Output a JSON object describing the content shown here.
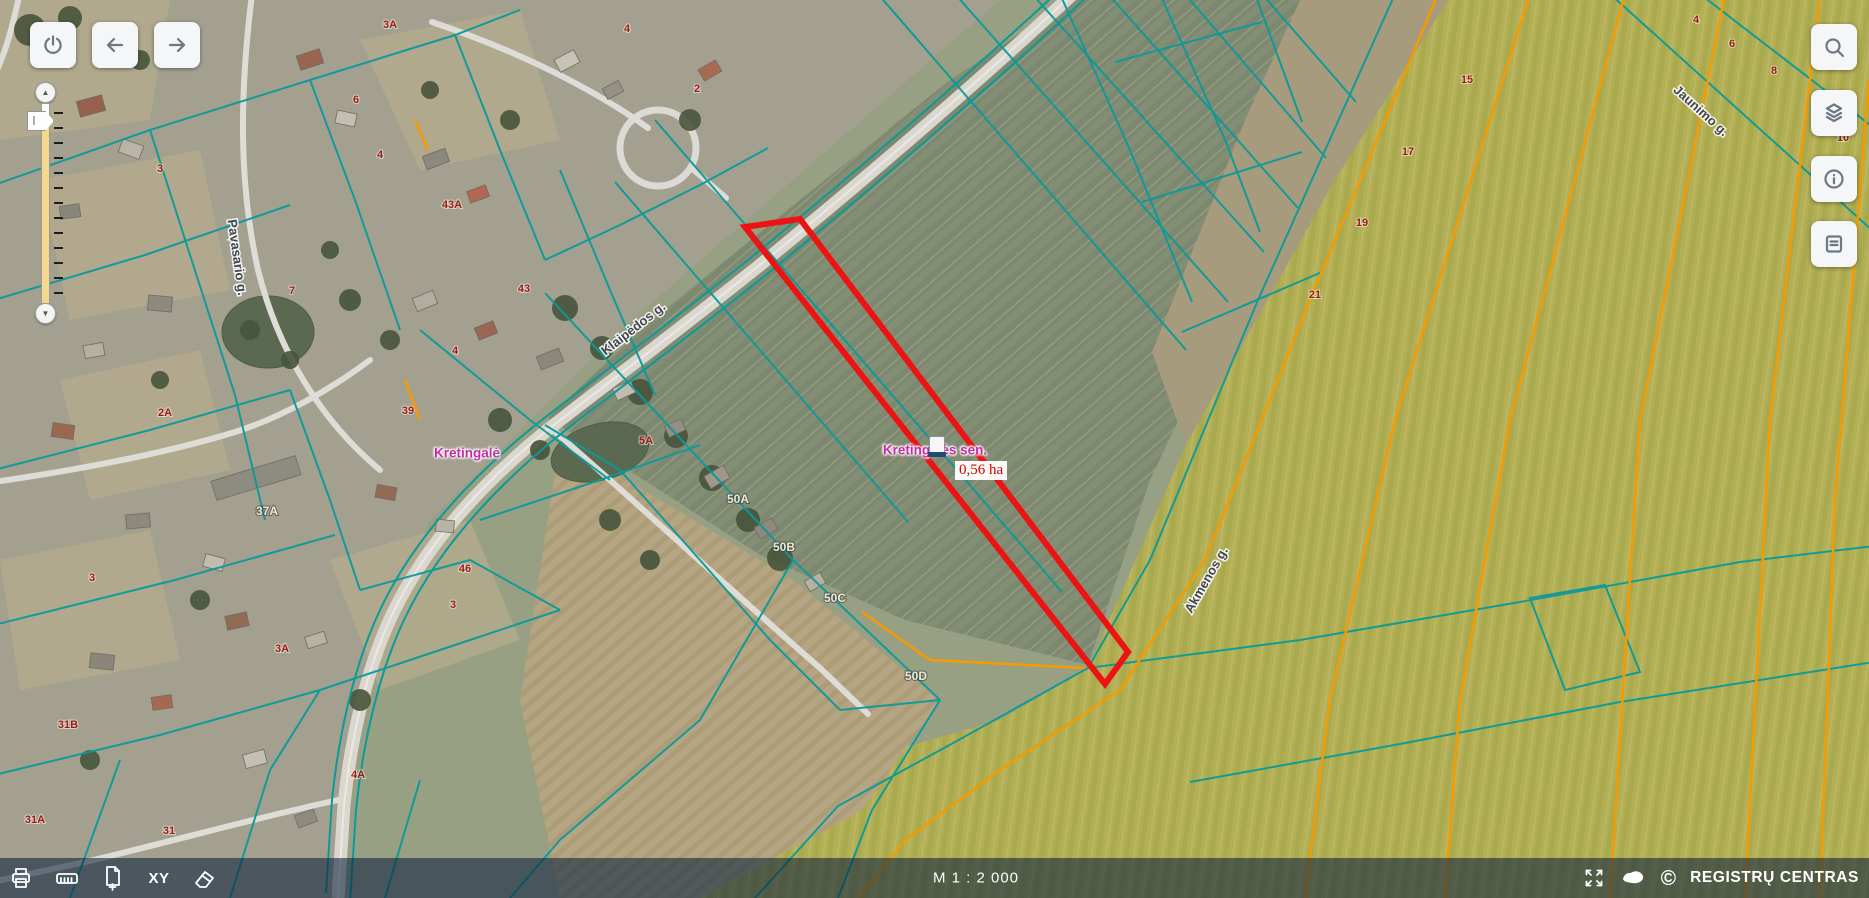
{
  "toolbars": {
    "top_left": [
      {
        "id": "power"
      },
      {
        "id": "back"
      },
      {
        "id": "forward"
      }
    ],
    "top_right": [
      {
        "id": "search"
      },
      {
        "id": "layers"
      },
      {
        "id": "info"
      },
      {
        "id": "legend"
      }
    ]
  },
  "bottombar": {
    "tools_left": [
      "print",
      "measure-ruler",
      "add-page",
      "xy-coordinates",
      "eraser"
    ],
    "xy_label": "XY",
    "scale": "M 1 : 2 000",
    "tools_right": [
      "fullscreen",
      "lithuania-map"
    ],
    "copyright_symbol": "©",
    "brand": "REGISTRŲ CENTRAS"
  },
  "map": {
    "selection": {
      "name": "Kretingalės sen.",
      "area": "0,56 ha"
    },
    "place": "Kretingalė",
    "colors": {
      "cadastral_line": "#0a9a9a",
      "agro_block_line": "#f59b00",
      "selected_parcel": "#ed1313",
      "label_magenta": "#c42ca5",
      "area_label_red": "#d40000",
      "road": "#d9d7cf"
    },
    "street_labels": [
      {
        "t": "Klaipėdos g.",
        "x": 636,
        "y": 332,
        "r": -38
      },
      {
        "t": "Pavasario g.",
        "x": 233,
        "y": 258,
        "r": 82
      },
      {
        "t": "Akmenos g.",
        "x": 1210,
        "y": 582,
        "r": -60
      },
      {
        "t": "Jaunimo g.",
        "x": 1698,
        "y": 114,
        "r": 42
      }
    ],
    "house_numbers_red": [
      {
        "t": "3A",
        "x": 390,
        "y": 28
      },
      {
        "t": "4",
        "x": 627,
        "y": 32
      },
      {
        "t": "6",
        "x": 356,
        "y": 103
      },
      {
        "t": "2",
        "x": 697,
        "y": 92
      },
      {
        "t": "3",
        "x": 160,
        "y": 172
      },
      {
        "t": "4",
        "x": 380,
        "y": 158
      },
      {
        "t": "43A",
        "x": 452,
        "y": 208
      },
      {
        "t": "43",
        "x": 524,
        "y": 292
      },
      {
        "t": "7",
        "x": 292,
        "y": 294
      },
      {
        "t": "4",
        "x": 455,
        "y": 354
      },
      {
        "t": "39",
        "x": 408,
        "y": 414
      },
      {
        "t": "2A",
        "x": 165,
        "y": 416
      },
      {
        "t": "5A",
        "x": 646,
        "y": 444
      },
      {
        "t": "46",
        "x": 465,
        "y": 572
      },
      {
        "t": "3",
        "x": 92,
        "y": 581
      },
      {
        "t": "3",
        "x": 453,
        "y": 608
      },
      {
        "t": "3A",
        "x": 282,
        "y": 652
      },
      {
        "t": "31B",
        "x": 68,
        "y": 728
      },
      {
        "t": "4A",
        "x": 358,
        "y": 778
      },
      {
        "t": "31A",
        "x": 35,
        "y": 823
      },
      {
        "t": "31",
        "x": 169,
        "y": 834
      },
      {
        "t": "15",
        "x": 1467,
        "y": 83
      },
      {
        "t": "17",
        "x": 1408,
        "y": 155
      },
      {
        "t": "19",
        "x": 1362,
        "y": 226
      },
      {
        "t": "21",
        "x": 1315,
        "y": 298
      },
      {
        "t": "4",
        "x": 1696,
        "y": 23
      },
      {
        "t": "6",
        "x": 1732,
        "y": 47
      },
      {
        "t": "8",
        "x": 1774,
        "y": 74
      },
      {
        "t": "10",
        "x": 1843,
        "y": 141
      }
    ],
    "house_numbers_light": [
      {
        "t": "37A",
        "x": 267,
        "y": 515
      },
      {
        "t": "50A",
        "x": 738,
        "y": 503
      },
      {
        "t": "50B",
        "x": 784,
        "y": 551
      },
      {
        "t": "50C",
        "x": 835,
        "y": 602
      },
      {
        "t": "50D",
        "x": 916,
        "y": 680
      }
    ],
    "geometry": {
      "fields": [
        {
          "points": "0,0 1000,0 620,330 430,520 360,680 330,898 0,898",
          "fill": "#a3a090"
        },
        {
          "points": "1070,0 1355,0 1240,290 1150,480 1088,665 905,620 760,555 548,418 640,330 800,200 950,80",
          "fill": "url(#pGreen)"
        },
        {
          "points": "1300,0 1448,0 1332,185 1186,445 1152,352 1245,120",
          "fill": "#a79b7d"
        },
        {
          "points": "1448,0 1869,0 1869,898 690,898 860,760 1000,720 1088,668 1186,445 1332,185",
          "fill": "url(#pYellow)"
        },
        {
          "points": "560,440 793,580 940,700 862,810 700,898 560,898 520,700",
          "fill": "url(#pPlow)"
        }
      ],
      "patches": [
        "0,0 170,0 150,120 0,140",
        "360,40 520,10 560,140 420,170",
        "40,180 200,150 230,290 70,320",
        "0,560 150,530 180,660 20,690",
        "330,560 470,520 520,640 380,690",
        "60,380 200,350 230,470 90,500"
      ],
      "ponds": [
        {
          "cx": 268,
          "cy": 332,
          "rx": 46,
          "ry": 36,
          "rot": 0
        },
        {
          "cx": 600,
          "cy": 452,
          "rx": 50,
          "ry": 28,
          "rot": -15
        }
      ],
      "road_main": "M1075,-8 C980,80 870,175 760,265 C660,345 585,400 545,432 C480,485 425,545 392,615 C365,672 350,745 344,805 L338,898",
      "lanes": [
        "M252,-6 C240,90 238,180 258,270 C278,350 320,420 380,470",
        "M-6,482 C90,468 170,452 235,432 C280,418 330,390 370,360",
        "M338,800 C255,818 170,842 85,862 L-8,882",
        "M20,-8 C12,30 4,58 -8,80",
        "M432,22 C520,52 592,88 648,128",
        "M553,430 C640,505 730,590 820,668 L868,714",
        "M694,170 L726,198"
      ],
      "teal_paths": [
        "M878,-6 L1186,350",
        "M955,-6 L1228,302",
        "M1032,-6 L1264,252",
        "M1108,-6 L1298,208",
        "M1185,-6 L1326,158",
        "M1262,-6 L1356,102",
        "M655,120 L1062,592",
        "M615,182 L908,522",
        "M1395,-6 L1258,300 L1150,560 L1088,668 L955,742 L838,806 L755,898",
        "M545,293 L793,560 L940,700",
        "M793,560 L700,720 L560,840 L510,898",
        "M940,700 L872,810 L838,898",
        "M-6,185 L150,130 L310,80 L455,35 L520,10",
        "M-6,300 L145,255 L290,205",
        "M150,130 L190,255 L235,395 L265,520",
        "M310,80 L355,200 L400,330",
        "M455,35 L500,150 L545,260",
        "M-6,470 L150,430 L290,390",
        "M-6,625 L175,580 L335,535",
        "M-6,775 L160,735 L320,690",
        "M70,898 L120,760",
        "M230,898 L270,770 L320,690",
        "M385,898 L420,780",
        "M320,690 L455,645 L560,610",
        "M545,260 L620,225 L700,185 L768,148",
        "M560,170 L610,290 L655,395",
        "M420,330 L530,420 L610,480",
        "M290,390 L330,500 L360,590",
        "M480,520 L600,480 L700,445",
        "M360,590 L470,560 L560,610",
        "M620,470 L700,560 L770,640 L840,710",
        "M545,425 L620,470",
        "M840,710 L940,700",
        "M1060,-6 L1130,150 L1192,302",
        "M1160,-6 L1226,142 L1260,232",
        "M1255,-6 L1302,122",
        "M1115,62 L1262,22",
        "M1142,202 L1302,152",
        "M1182,332 L1322,272",
        "M1088,668 L1300,640 L1520,602 L1740,562 L1874,546",
        "M1190,782 L1400,744 L1620,702 L1874,662",
        "M1530,598 L1565,690 L1640,672 L1605,585 Z",
        "M1610,-6 L1874,232",
        "M1700,-6 L1874,128"
      ],
      "orange_paths": [
        "M1438,-6 L1310,300 L1205,560 L1120,690 L1000,770 L905,840 L860,898",
        "M1530,-6 L1395,420 L1330,700 L1305,898",
        "M1625,-6 L1510,420 L1460,700 L1445,898",
        "M1725,-6 L1640,420 L1610,898",
        "M1820,-6 L1770,420 L1745,898",
        "M1869,80 L1835,500 L1820,898",
        "M862,612 L930,660 L1085,668",
        "M405,380 L420,420",
        "M415,120 L428,150"
      ],
      "red_parcel": "745,227 800,219 1128,652 1105,684",
      "trees": [
        [
          565,
          308,
          13
        ],
        [
          602,
          348,
          12
        ],
        [
          640,
          392,
          13
        ],
        [
          676,
          436,
          12
        ],
        [
          712,
          478,
          13
        ],
        [
          748,
          520,
          12
        ],
        [
          780,
          558,
          13
        ],
        [
          30,
          30,
          16
        ],
        [
          70,
          18,
          12
        ],
        [
          140,
          60,
          10
        ],
        [
          430,
          90,
          9
        ],
        [
          510,
          120,
          10
        ],
        [
          690,
          120,
          11
        ],
        [
          330,
          250,
          9
        ],
        [
          350,
          300,
          11
        ],
        [
          390,
          340,
          10
        ],
        [
          250,
          330,
          10
        ],
        [
          290,
          360,
          9
        ],
        [
          160,
          380,
          9
        ],
        [
          500,
          420,
          12
        ],
        [
          540,
          450,
          10
        ],
        [
          610,
          520,
          11
        ],
        [
          650,
          560,
          10
        ],
        [
          200,
          600,
          10
        ],
        [
          360,
          700,
          11
        ],
        [
          90,
          760,
          10
        ]
      ],
      "houses": [
        [
          78,
          98,
          26,
          16,
          -15,
          "#95604c"
        ],
        [
          120,
          142,
          22,
          14,
          20,
          "#b9b4a6"
        ],
        [
          60,
          205,
          20,
          13,
          -8,
          "#8a857a"
        ],
        [
          298,
          52,
          24,
          15,
          -18,
          "#9a6550"
        ],
        [
          336,
          112,
          20,
          13,
          12,
          "#c2beb0"
        ],
        [
          424,
          152,
          24,
          14,
          -20,
          "#8d887c"
        ],
        [
          468,
          188,
          20,
          12,
          -20,
          "#b06852"
        ],
        [
          556,
          54,
          22,
          14,
          -28,
          "#c6c2b4"
        ],
        [
          604,
          84,
          18,
          12,
          -28,
          "#969184"
        ],
        [
          700,
          64,
          20,
          13,
          -30,
          "#a86a52"
        ],
        [
          148,
          296,
          24,
          15,
          5,
          "#8f8a7e"
        ],
        [
          84,
          344,
          20,
          13,
          -10,
          "#b5b0a2"
        ],
        [
          52,
          424,
          22,
          14,
          8,
          "#9c6750"
        ],
        [
          126,
          514,
          24,
          14,
          -5,
          "#8e897d"
        ],
        [
          204,
          556,
          20,
          13,
          15,
          "#c0bcae"
        ],
        [
          226,
          614,
          22,
          14,
          -12,
          "#926b54"
        ],
        [
          306,
          634,
          20,
          12,
          -18,
          "#b7b2a4"
        ],
        [
          90,
          654,
          24,
          15,
          6,
          "#8b867a"
        ],
        [
          152,
          696,
          20,
          13,
          -8,
          "#a56850"
        ],
        [
          244,
          752,
          22,
          14,
          -15,
          "#c3bfb1"
        ],
        [
          296,
          812,
          20,
          13,
          -20,
          "#8f8a7e"
        ],
        [
          414,
          294,
          22,
          14,
          -22,
          "#b2ad9f"
        ],
        [
          476,
          324,
          20,
          13,
          -22,
          "#996652"
        ],
        [
          538,
          352,
          24,
          14,
          -22,
          "#8c877b"
        ],
        [
          614,
          384,
          20,
          13,
          -25,
          "#c0bcae"
        ],
        [
          666,
          422,
          18,
          12,
          -25,
          "#948f83"
        ],
        [
          706,
          470,
          22,
          14,
          -30,
          "#a0988a"
        ],
        [
          756,
          522,
          20,
          13,
          -30,
          "#8e897d"
        ],
        [
          806,
          576,
          18,
          12,
          -30,
          "#b5b0a2"
        ],
        [
          376,
          486,
          20,
          13,
          10,
          "#926b54"
        ],
        [
          436,
          520,
          18,
          12,
          5,
          "#b9b4a6"
        ],
        [
          212,
          468,
          88,
          20,
          -17,
          "#8e8b80"
        ]
      ]
    }
  }
}
